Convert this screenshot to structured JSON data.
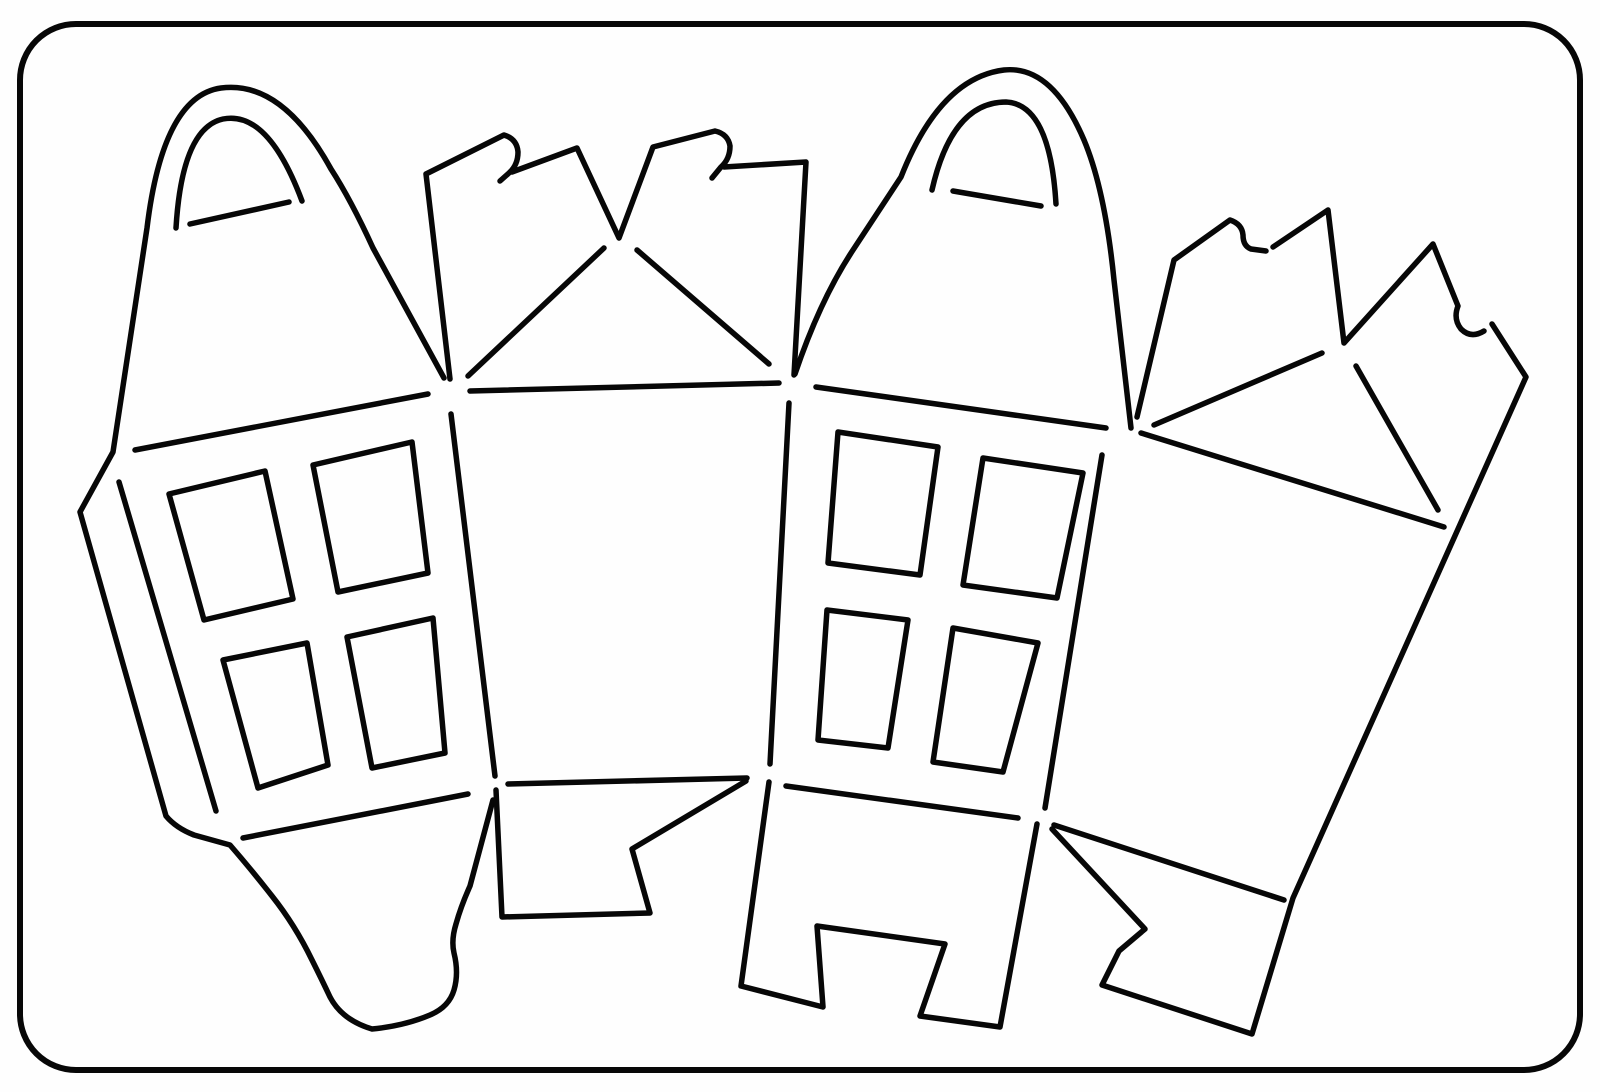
{
  "title": "house-box-dieline-template",
  "canvas": {
    "width": 1600,
    "height": 1092,
    "background": "#fefefe",
    "line_color": "#070707",
    "line_width": 5.5
  },
  "border": {
    "x": 20,
    "y": 24,
    "width": 1560,
    "height": 1046,
    "radius": 56,
    "line_color": "#070707",
    "line_width": 6
  },
  "shapes": [
    {
      "name": "house1-outer-outline-gable-body-and-bottom-tab",
      "d": "M444,378 L373,248 Q351,200 331,169 Q282,80 221,88 Q163,96 147,228 L113,452 L80,512 L166,816 Q176,828 194,835 L230,845 Q250,868 272,896 Q295,925 312,960 Q322,980 330,997 Q342,1020 372,1029 Q404,1026 430,1015 Q449,1007 454,990 Q459,973 454,953 Q451,940 456,924 Q461,906 470,886 L493,800"
    },
    {
      "name": "house1-fanlight-arch",
      "d": "M176,228 Q182,128 223,119 Q268,110 302,201"
    },
    {
      "name": "house1-fanlight-chord",
      "d": "M190,224 L289,202"
    },
    {
      "name": "house1-wall-top-fold",
      "d": "M135,450 L428,394"
    },
    {
      "name": "house1-wall-left-fold",
      "d": "M119,482 L216,811"
    },
    {
      "name": "house1-wall-right-fold",
      "d": "M451,414 L495,776"
    },
    {
      "name": "house1-wall-bottom-fold",
      "d": "M243,838 L468,794"
    },
    {
      "name": "house1-window-top-left",
      "d": "M169,494 L265,471 L293,599 L204,620 Z"
    },
    {
      "name": "house1-window-top-right",
      "d": "M313,465 L412,442 L428,573 L338,592 Z"
    },
    {
      "name": "house1-window-bottom-left",
      "d": "M223,660 L307,643 L328,765 L258,788 Z"
    },
    {
      "name": "house1-window-bottom-right",
      "d": "M347,637 L433,618 L445,753 L372,768 Z"
    },
    {
      "name": "roof-flap-group1-left-edge-and-first-hook-tab",
      "d": "M450,379 L426,174 L504,135 Q517,139 518,152 Q518,165 509,173 L500,181"
    },
    {
      "name": "roof-flap-group1-center-vee-and-second-hook-tab",
      "d": "M512,172 L577,148 L619,238 L653,147 L715,131 Q728,134 730,146 Q730,159 721,167 L712,178"
    },
    {
      "name": "roof-flap-group1-right-edge",
      "d": "M724,167 L806,162 L794,375"
    },
    {
      "name": "side-panel1-roof-fold-line",
      "d": "M470,391 L779,383"
    },
    {
      "name": "side-panel1-roof-diagonal-left",
      "d": "M604,248 L468,376"
    },
    {
      "name": "side-panel1-roof-diagonal-right",
      "d": "M637,250 L769,364"
    },
    {
      "name": "side-panel1-bottom-flap-notched",
      "d": "M496,790 L502,917 L650,913 L632,849 L746,781"
    },
    {
      "name": "side-panel1-bottom-fold-line",
      "d": "M508,784 L747,778"
    },
    {
      "name": "house2-outer-gable-outline",
      "d": "M795,374 Q820,300 853,250 Q878,212 901,177 Q940,78 1004,70 Q1052,65 1084,140 Q1105,190 1114,280 L1131,428"
    },
    {
      "name": "house2-fanlight-arch",
      "d": "M932,190 Q952,102 1006,102 Q1050,104 1056,204"
    },
    {
      "name": "house2-fanlight-chord",
      "d": "M953,191 L1041,206"
    },
    {
      "name": "house2-wall-top-fold",
      "d": "M816,387 L1106,428"
    },
    {
      "name": "house2-wall-left-fold",
      "d": "M789,403 L770,764"
    },
    {
      "name": "house2-wall-right-fold",
      "d": "M1102,455 L1045,808"
    },
    {
      "name": "house2-wall-bottom-fold",
      "d": "M786,786 L1018,818"
    },
    {
      "name": "house2-window-top-left",
      "d": "M838,432 L938,447 L920,575 L828,563 Z"
    },
    {
      "name": "house2-window-top-right",
      "d": "M983,458 L1083,473 L1057,598 L963,585 Z"
    },
    {
      "name": "house2-window-bottom-left",
      "d": "M827,610 L908,620 L888,748 L818,740 Z"
    },
    {
      "name": "house2-window-bottom-right",
      "d": "M953,628 L1038,643 L1003,772 L933,762 Z"
    },
    {
      "name": "house2-bottom-tab-two-feet",
      "d": "M769,782 L741,986 L823,1007 L817,926 L945,944 L920,1016 L1000,1027 L1037,824"
    },
    {
      "name": "roof-flap-group2-left-edge-and-hook-tab",
      "d": "M1137,417 L1174,260 L1230,220 Q1242,224 1243,235 Q1243,246 1251,249 L1266,251"
    },
    {
      "name": "roof-flap-group2-vee-peak-and-hook-tab",
      "d": "M1273,247 L1328,210 L1344,343 L1433,244 L1458,306 Q1453,319 1461,329 Q1471,339 1484,331"
    },
    {
      "name": "side-panel2-right-edge-and-bottom-tab-notched",
      "d": "M1492,324 L1526,377 L1293,898 L1252,1034 L1102,985 L1119,951 L1145,929 L1052,829"
    },
    {
      "name": "side-panel2-roof-fold-line",
      "d": "M1141,433 L1444,527"
    },
    {
      "name": "side-panel2-roof-diagonal-left",
      "d": "M1322,353 L1154,425"
    },
    {
      "name": "side-panel2-roof-diagonal-right",
      "d": "M1356,366 L1438,510"
    },
    {
      "name": "side-panel2-bottom-fold-line",
      "d": "M1054,825 L1284,900"
    }
  ]
}
